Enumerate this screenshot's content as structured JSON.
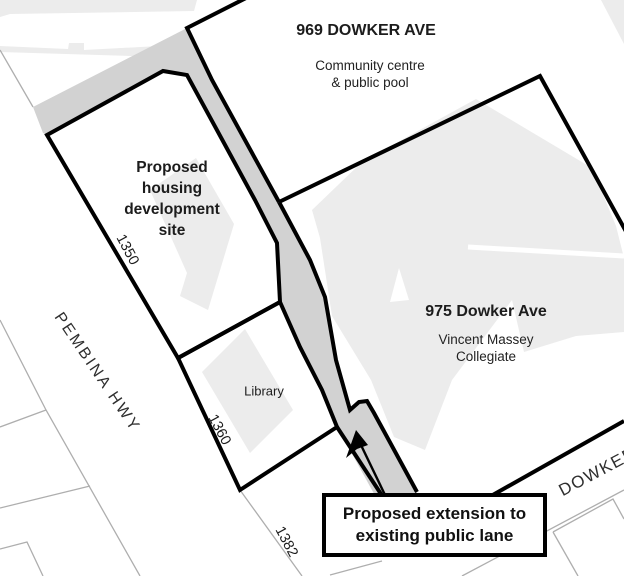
{
  "map": {
    "labels": {
      "parcel_969": {
        "title": "969 DOWKER AVE",
        "subtitle_line1": "Community centre",
        "subtitle_line2": "& public pool"
      },
      "housing_site": {
        "line1": "Proposed",
        "line2": "housing",
        "line3": "development",
        "line4": "site",
        "lot_number": "1350"
      },
      "parcel_975": {
        "title": "975 Dowker Ave",
        "subtitle_line1": "Vincent Massey",
        "subtitle_line2": "Collegiate"
      },
      "library": {
        "name": "Library",
        "lot_number": "1360"
      },
      "lot_1382": {
        "lot_number": "1382"
      },
      "streets": {
        "pembina": "PEMBINA HWY",
        "dowker": "DOWKER"
      },
      "callout": {
        "line1": "Proposed extension to",
        "line2": "existing public lane"
      }
    },
    "colors": {
      "background": "#ffffff",
      "lane_fill": "#d2d2d2",
      "building_footprint_fill": "#ececec",
      "parcel_outline": "#000000",
      "thin_parcel_line": "#aeaeae",
      "text": "#1c1c1c"
    }
  }
}
